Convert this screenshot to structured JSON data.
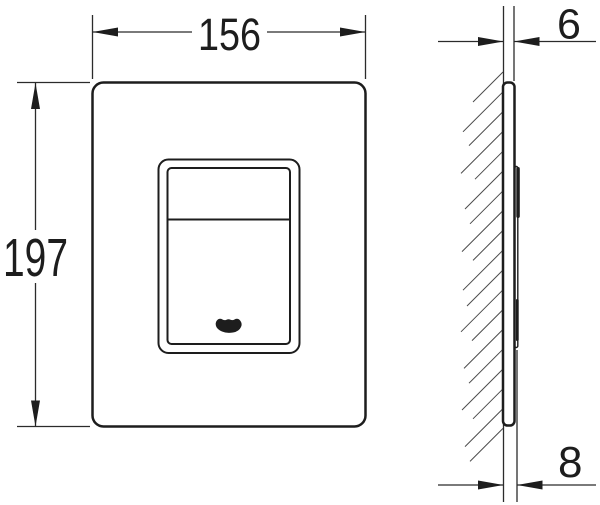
{
  "drawing": {
    "type": "technical-dimension-drawing",
    "views": {
      "front": {
        "width_dimension": "156",
        "height_dimension": "197"
      },
      "side": {
        "top_depth_dimension": "6",
        "bottom_depth_dimension": "8"
      }
    },
    "logo_icon": "grohe-logo",
    "colors": {
      "line": "#1d1d1d",
      "dimension_line": "#2b2b2b",
      "hatch": "#4a4a4a",
      "background": "#ffffff"
    }
  }
}
